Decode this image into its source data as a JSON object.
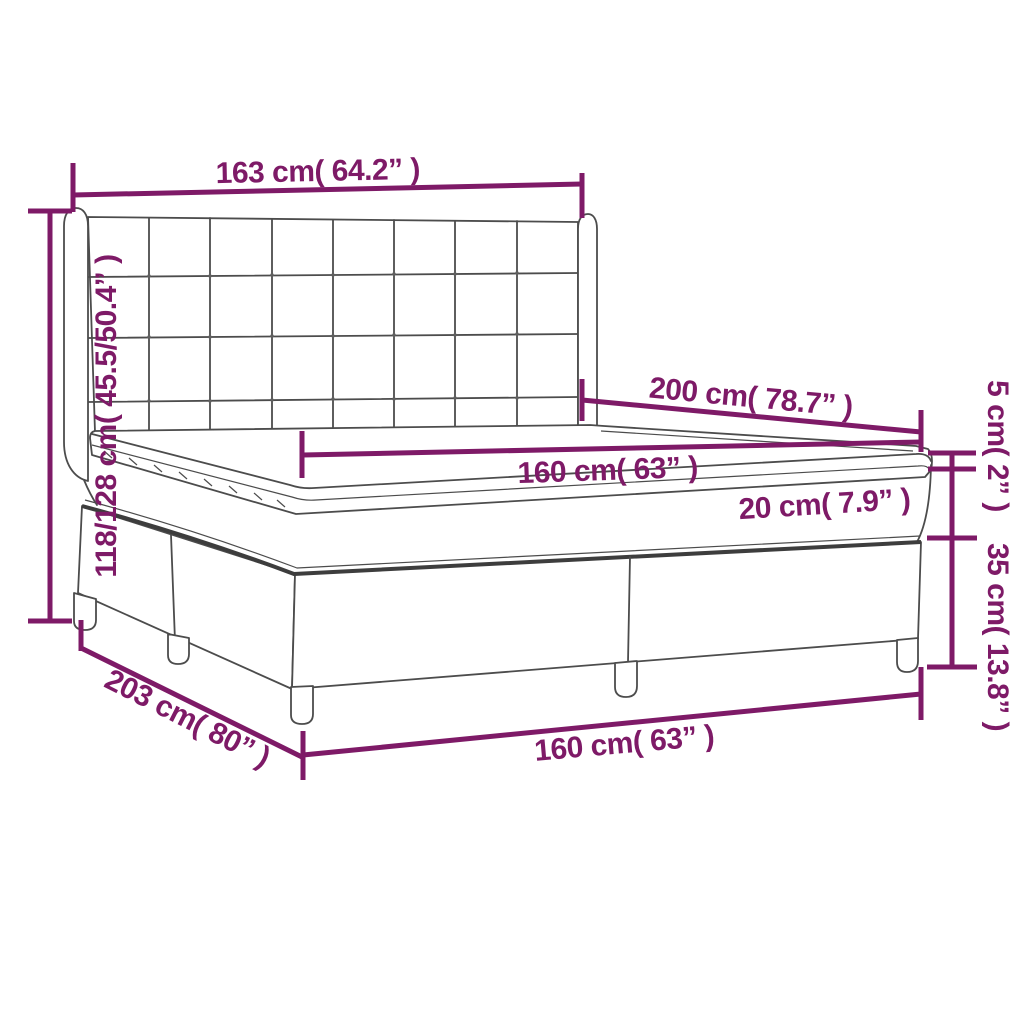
{
  "diagram": {
    "subject": "box-spring-bed-with-winged-headboard-dimension-diagram",
    "colors": {
      "dimension_accent": "#7E1A67",
      "artwork_outline": "#4C4C4C",
      "background": "#FFFFFF"
    },
    "labels": {
      "headboard_width": "163 cm( 64.2” )",
      "overall_height": "118/128 cm( 45.5/50.4” )",
      "mattress_length": "200 cm( 78.7” )",
      "mattress_width": "160 cm( 63” )",
      "mattress_thickness": "20 cm( 7.9” )",
      "topper_thickness": "5 cm( 2” )",
      "base_height": "35 cm( 13.8” )",
      "overall_length": "203 cm( 80” )",
      "overall_width": "160 cm( 63” )"
    }
  }
}
